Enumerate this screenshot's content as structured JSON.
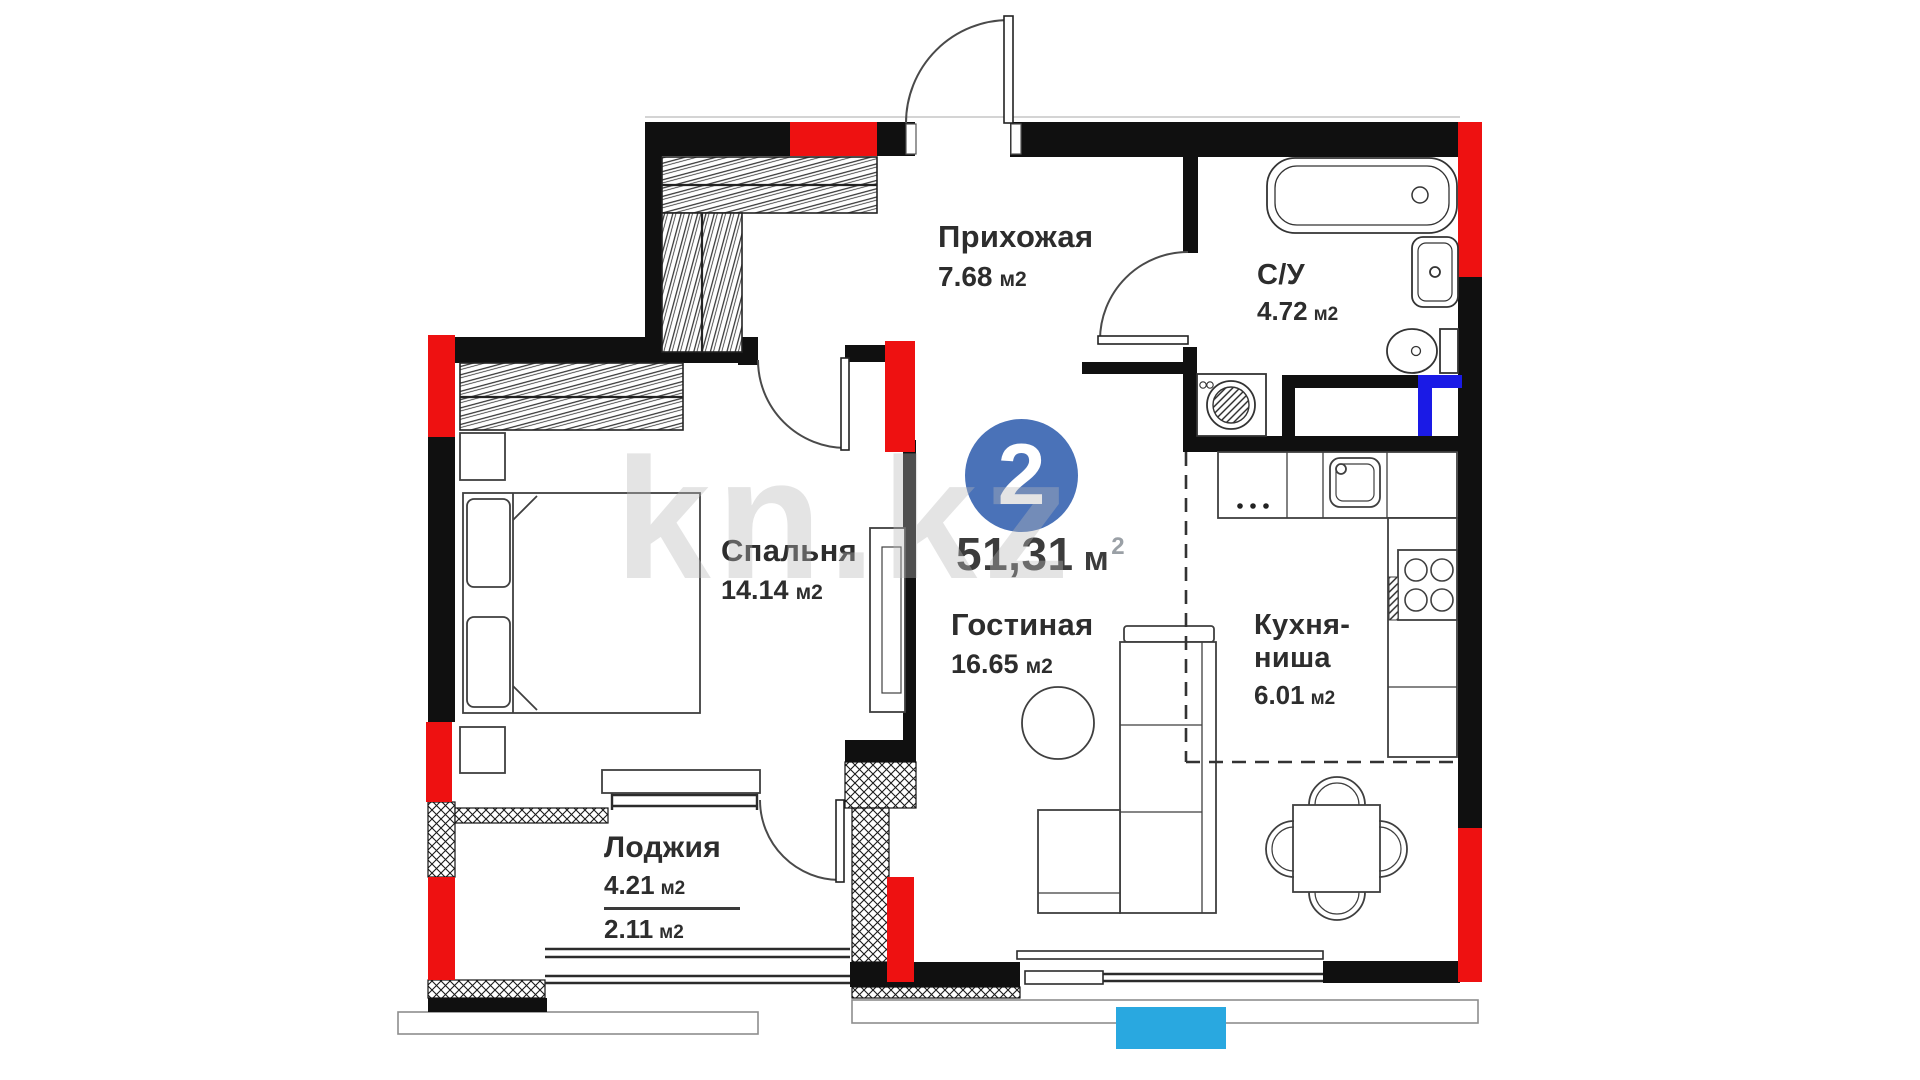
{
  "plan": {
    "badge_number": "2",
    "total_area": {
      "value": "51,31",
      "unit": "м",
      "sup": "2"
    },
    "watermark": "kn.kz",
    "rooms": [
      {
        "name": "Прихожая",
        "area": "7.68",
        "unit": "м2"
      },
      {
        "name": "С/У",
        "area": "4.72",
        "unit": "м2"
      },
      {
        "name": "Спальня",
        "area": "14.14",
        "unit": "м2"
      },
      {
        "name": "Гостиная",
        "area": "16.65",
        "unit": "м2"
      },
      {
        "name": "Кухня-",
        "name2": "ниша",
        "area": "6.01",
        "unit": "м2"
      },
      {
        "name": "Лоджия",
        "area": "4.21",
        "unit": "м2",
        "area2": "2.11",
        "unit2": "м2"
      }
    ],
    "colors": {
      "wall": "#101010",
      "highlight_red": "#ee1111",
      "badge_blue": "#4a72b8",
      "balcony_blue": "#29a8e0",
      "duct_blue": "#1a1ae6",
      "text": "#2d2d2d"
    }
  }
}
